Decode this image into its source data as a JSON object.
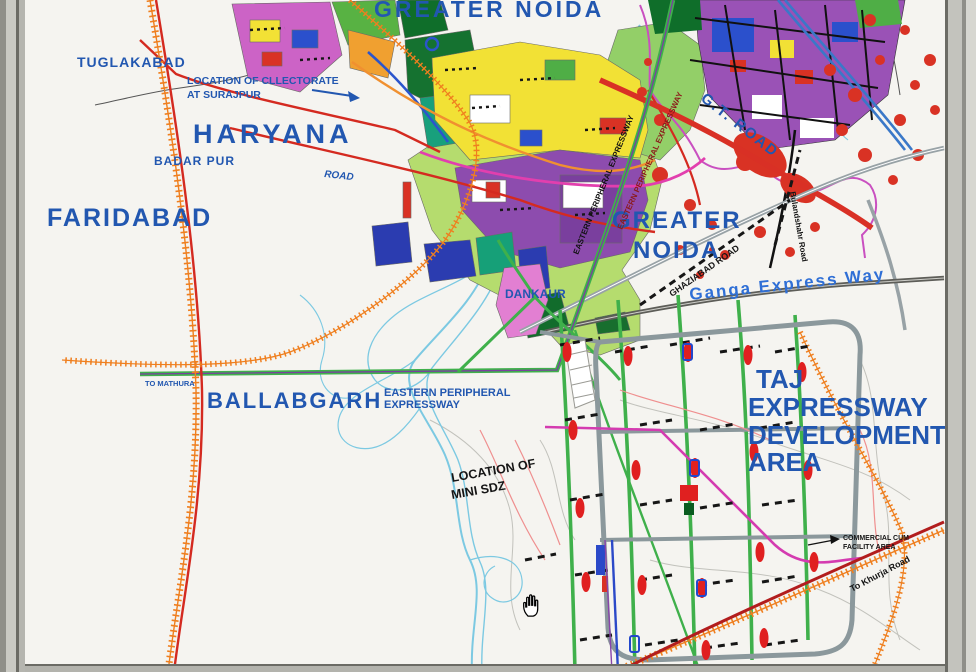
{
  "map": {
    "title": "GREATER NOIDA",
    "place_labels": {
      "tuglakabad": "TUGLAKABAD",
      "haryana": "HARYANA",
      "faridabad": "FARIDABAD",
      "badar_pur": "BADAR PUR",
      "road": "ROAD",
      "ballabgarh": "BALLABGARH",
      "to_mathura": "TO MATHURA",
      "dankaur": "DANKAUR",
      "greater_noida_1": "GREATER",
      "greater_noida_2": "NOIDA"
    },
    "annotations": {
      "collectorate_1": "LOCATION OF CLLECTORATE",
      "collectorate_2": "AT SURAJPUR",
      "mini_sdz_1": "LOCATION OF",
      "mini_sdz_2": "MINI SDZ",
      "taj_1": "TAJ",
      "taj_2": "EXPRESSWAY",
      "taj_3": "DEVELOPMENT",
      "taj_4": "AREA",
      "commercial_1": "COMMERCIAL CUM",
      "commercial_2": "FACILITY AREA"
    },
    "road_labels": {
      "ganga_expressway": "Ganga Express Way",
      "gt_road": "G.T. ROAD",
      "epe_blue_1": "EASTERN PERIPHERAL",
      "epe_blue_2": "EXPRESSWAY",
      "epe_road_1": "EASTERN PERIPHERAL EXPRESSWAY",
      "epe_road_2": "EASTERN PERIPHERAL EXPRESSWAY",
      "ghaziabad_road": "GHAZIABAD ROAD",
      "bulandshahr_road": "Bulandshahr Road",
      "to_khurja": "To Khurja Road"
    }
  },
  "colors": {
    "label_blue": "#2257b0",
    "railway_orange": "#ef7f1f",
    "road_red": "#d42a20",
    "dark_red_road": "#b21d1d",
    "expressway_green": "#3fb04b",
    "river_blue": "#7cc9e2",
    "ring_road_gray": "#8b989c",
    "magenta_road": "#d43bb0",
    "zone_yellow": "#f2e135",
    "zone_purple": "#8d4cae",
    "zone_light_green": "#b5dc6e",
    "village_red": "#d93224",
    "frame_gray": "#c9c9c3"
  },
  "cursor": {
    "type": "open-hand"
  }
}
